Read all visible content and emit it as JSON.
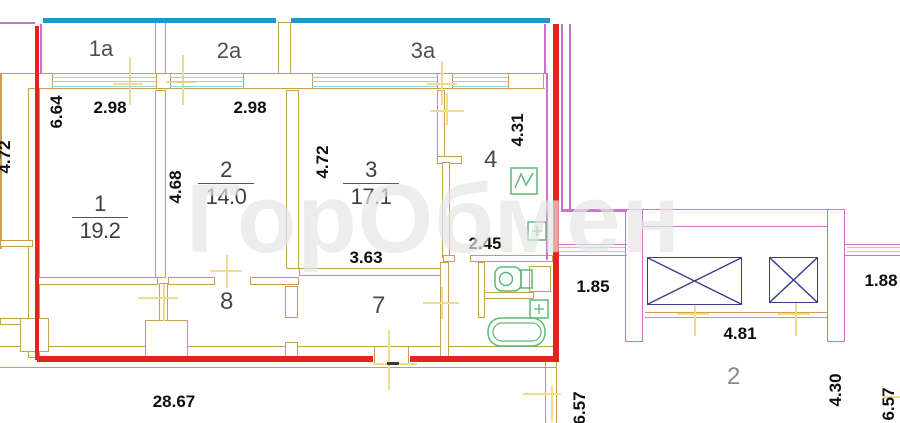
{
  "watermark": "ГорОбмен",
  "colors": {
    "tan": "#c79e52",
    "red": "#e62320",
    "blue": "#2196d3",
    "cyan": "#8fd8e2",
    "mag": "#cc72cc",
    "navy": "#3d3d8f",
    "green": "#5cb878",
    "yellow": "#f0dc8a",
    "dark": "#3a3a3a"
  },
  "balconies": [
    {
      "label": "1а"
    },
    {
      "label": "2а"
    },
    {
      "label": "3а"
    }
  ],
  "rooms_area": [
    {
      "number": "1",
      "area": "19.2"
    },
    {
      "number": "2",
      "area": "14.0"
    },
    {
      "number": "3",
      "area": "17.1"
    }
  ],
  "rooms_plain": [
    {
      "number": "4"
    },
    {
      "number": "8"
    },
    {
      "number": "7"
    },
    {
      "number": "2"
    }
  ],
  "dims": [
    {
      "value": "2.98"
    },
    {
      "value": "2.98"
    },
    {
      "value": "4.31"
    },
    {
      "value": "6.64"
    },
    {
      "value": "4.68"
    },
    {
      "value": "4.72"
    },
    {
      "value": "4.72"
    },
    {
      "value": "3.63"
    },
    {
      "value": "2.45"
    },
    {
      "value": "28.67"
    },
    {
      "value": "1.85"
    },
    {
      "value": "4.81"
    },
    {
      "value": "1.88"
    },
    {
      "value": "4.30"
    },
    {
      "value": "6.57"
    },
    {
      "value": "6.57"
    }
  ]
}
